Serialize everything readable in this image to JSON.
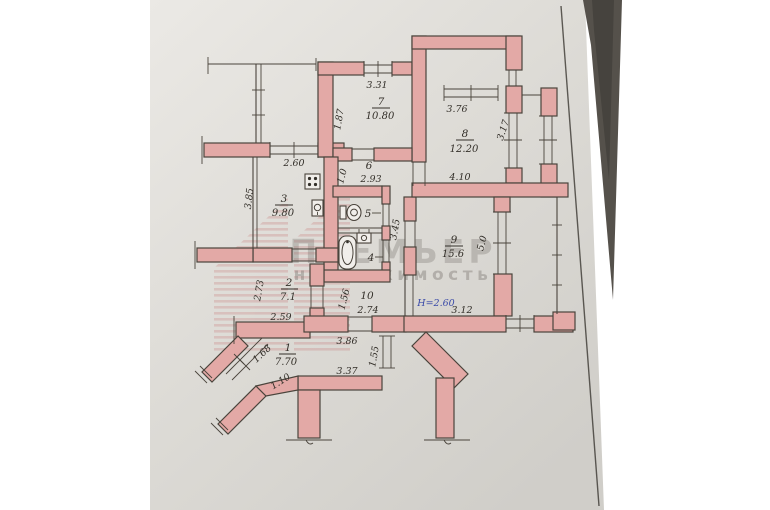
{
  "watermark": {
    "brand": "ПРЕМЬЕР",
    "tagline": "недвижимость"
  },
  "rooms": [
    {
      "number": "1",
      "area": "7.70"
    },
    {
      "number": "2",
      "area": "7.1"
    },
    {
      "number": "3",
      "area": "9.80"
    },
    {
      "number": "4",
      "area": ""
    },
    {
      "number": "5",
      "area": ""
    },
    {
      "number": "6",
      "area": ""
    },
    {
      "number": "7",
      "area": "10.80"
    },
    {
      "number": "8",
      "area": "12.20"
    },
    {
      "number": "9",
      "area": "15.6"
    },
    {
      "number": "10",
      "area": ""
    }
  ],
  "dimensions": {
    "kitchen_window": "2.60",
    "kitchen_left": "3.85",
    "room2_left": "2.73",
    "room2_bottom": "2.59",
    "room7_left": "1.87",
    "room7_top": "3.31",
    "corridor6_bottom": "2.93",
    "corridor6_left": "1.0",
    "room8_window": "3.76",
    "room8_right": "3.17",
    "room8_bottom": "4.10",
    "inner_corridor": "3.45",
    "room9_right": "5.0",
    "room9_bottom": "3.12",
    "corridor10_bottom": "2.74",
    "corridor10_left": "1.56",
    "hall_top": "3.86",
    "hall_bottom": "3.37",
    "hall_doorway": "1.55",
    "entry_door": "1.68",
    "entry_passage": "1.10"
  },
  "notes": {
    "ceiling_height": "Н=2.60"
  },
  "colors": {
    "wall_fill": "#e3a9a6",
    "wall_stroke": "#4a443c",
    "ink": "#332f29",
    "paper_light": "#e9e7e3",
    "paper_dark": "#d2d0cb",
    "height_note_ink": "#3a4aa8",
    "table": "#55514b",
    "watermark": "#7d7873"
  }
}
